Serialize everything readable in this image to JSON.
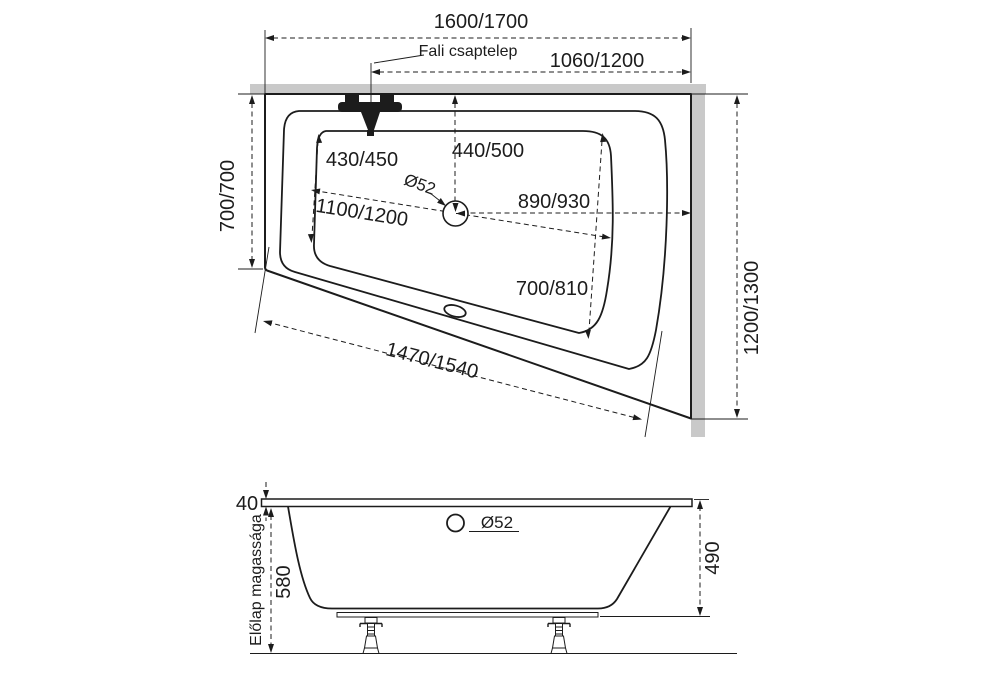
{
  "drawing": {
    "kind": "bathtub technical drawing, corner asymmetric model, two sizes",
    "units": "mm",
    "plan": {
      "overall_length": "1600/1700",
      "faucet_label": "Fali csaptelep",
      "faucet_to_corner": "1060/1200",
      "side_width": "700/700",
      "basin_left_depth": "430/450",
      "drain_from_wall": "440/500",
      "drain_diameter": "Ø52",
      "basin_length": "1100/1200",
      "drain_to_corner": "890/930",
      "basin_right_depth": "700/810",
      "front_edge_length": "1470/1540",
      "overall_width": "1200/1300"
    },
    "side": {
      "rim_thickness": "40",
      "front_panel_label": "Előlap magassága",
      "front_panel_height": "580",
      "overflow_diameter": "Ø52",
      "inner_depth": "490"
    }
  }
}
